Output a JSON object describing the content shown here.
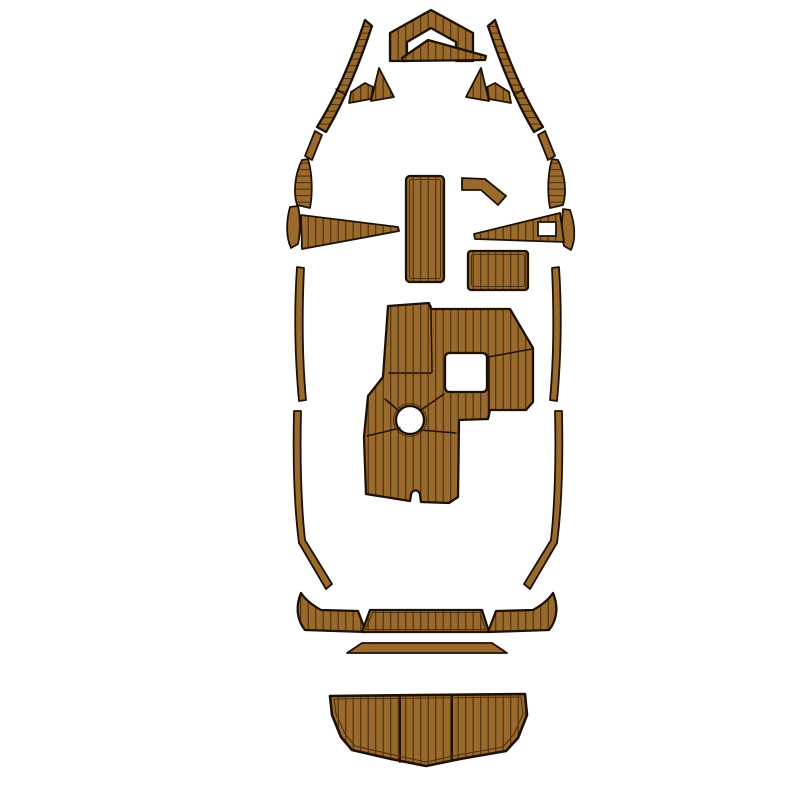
{
  "meta": {
    "label": "Boat EVA foam teak decking pad set - top view diagram",
    "canvas": {
      "width": 800,
      "height": 800
    }
  },
  "colors": {
    "background": "#ffffff",
    "pad_fill": "#9a6a2c",
    "plank_line": "#4e3312",
    "outline": "#1e1104"
  },
  "pieces": [
    {
      "id": "bow-cap-pad"
    },
    {
      "id": "bow-center-triangle-pad"
    },
    {
      "id": "port-bow-rail-upper"
    },
    {
      "id": "starboard-bow-rail-upper"
    },
    {
      "id": "port-bow-rail-lower"
    },
    {
      "id": "starboard-bow-rail-lower"
    },
    {
      "id": "port-small-wedge-pad"
    },
    {
      "id": "port-small-triangle-pad"
    },
    {
      "id": "starboard-small-triangle-pad"
    },
    {
      "id": "starboard-small-wedge-pad"
    },
    {
      "id": "port-side-tread-pad"
    },
    {
      "id": "starboard-side-tread-pad"
    },
    {
      "id": "port-side-tread-lower"
    },
    {
      "id": "starboard-side-tread-lower"
    },
    {
      "id": "center-walkway-pad"
    },
    {
      "id": "starboard-elbow-pad"
    },
    {
      "id": "port-step-wedge-pad"
    },
    {
      "id": "starboard-step-wedge-pad"
    },
    {
      "id": "starboard-console-pad"
    },
    {
      "id": "cockpit-main-pad"
    },
    {
      "id": "port-gunwale-strip-upper"
    },
    {
      "id": "starboard-gunwale-strip-upper"
    },
    {
      "id": "port-gunwale-strip-lower"
    },
    {
      "id": "starboard-gunwale-strip-lower"
    },
    {
      "id": "transom-corner-port-pad"
    },
    {
      "id": "transom-center-pad"
    },
    {
      "id": "transom-corner-starboard-pad"
    },
    {
      "id": "stern-trim-strip"
    },
    {
      "id": "swim-platform-pad"
    }
  ]
}
